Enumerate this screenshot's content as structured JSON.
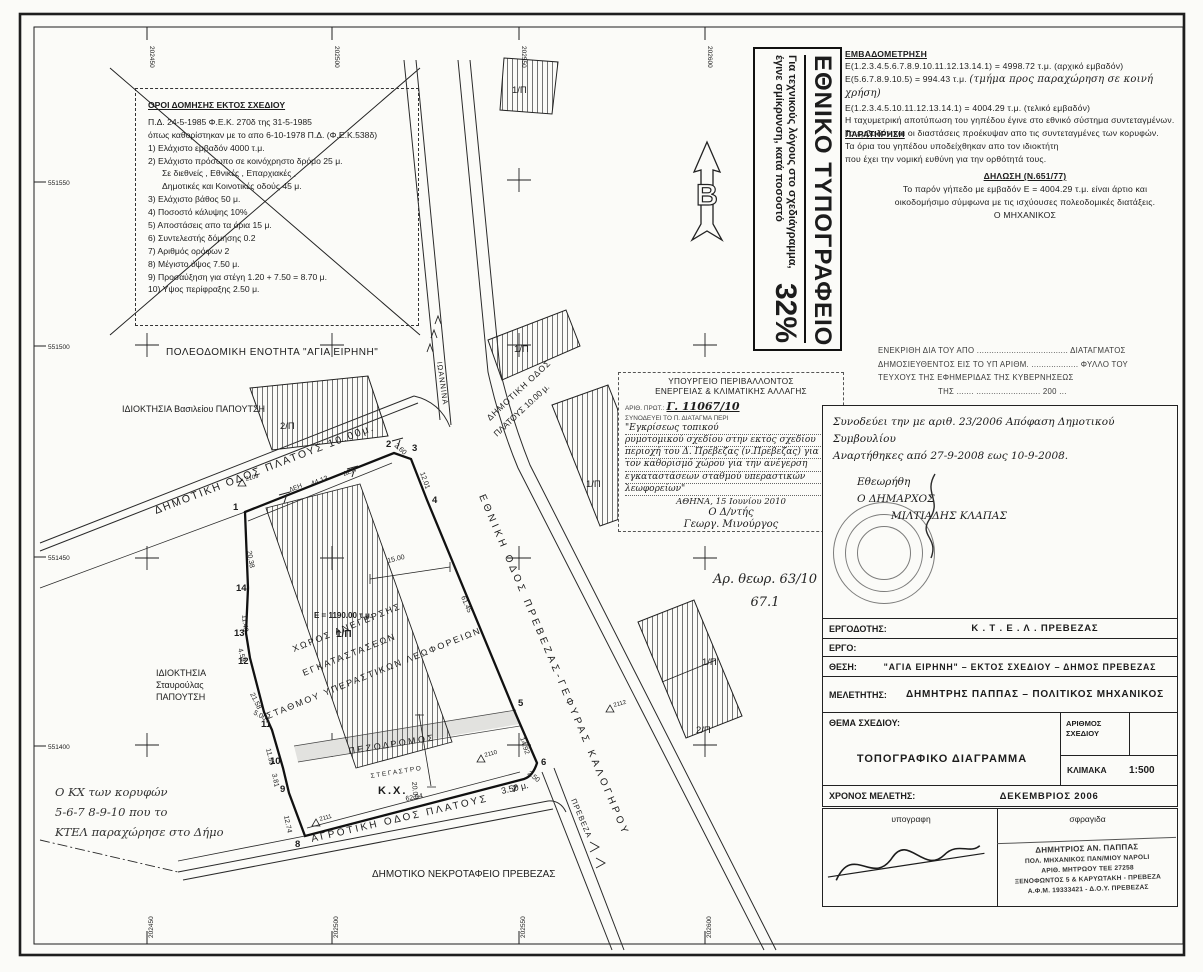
{
  "printing_office": {
    "title": "ΕΘΝΙΚΟ ΤΥΠΟΓΡΑΦΕΙΟ",
    "note": "Για τεχνικούς λόγους στο σχεδιάγραμμα, έγινε σμίκρυνση, κατά ποσοστό",
    "percent": "32%"
  },
  "regulations": {
    "title": "ΟΡΟΙ ΔΟΜΗΣΗΣ ΕΚΤΟΣ ΣΧΕΔΙΟΥ",
    "decree_line1": "Π.Δ. 24-5-1985 Φ.Ε.Κ. 270δ της 31-5-1985",
    "decree_line2": "όπως καθορίστηκαν με το απο 6-10-1978 Π.Δ. (Φ.Ε.Κ.538δ)",
    "items": [
      "1) Ελάχιστο εμβαδόν 4000 τ.μ.",
      "2) Ελάχιστο πρόσωπο σε κοινόχρηστο δρόμο 25 μ.",
      "Σε διεθνείς , Εθνικές , Επαρχιακές ,",
      "Δημοτικές και Κοινοτικές οδούς 45 μ.",
      "3) Ελάχιστο βάθος 50 μ.",
      "4) Ποσοστό κάλυψης 10%",
      "5) Αποστάσεις απο τα όρια 15 μ.",
      "6) Συντελεστής δόμησης 0.2",
      "7) Αριθμός ορόφων 2",
      "8) Μέγιστο ύψος 7.50 μ.",
      "9) Προσαύξηση για στέγη 1.20 + 7.50 = 8.70 μ.",
      "10) Υψος περίφραξης 2.50 μ."
    ]
  },
  "area_measurement": {
    "title": "ΕΜΒΑΔΟΜΕΤΡΗΣΗ",
    "line1": "Ε(1.2.3.4.5.6.7.8.9.10.11.12.13.14.1) = 4998.72 τ.μ. (αρχικό εμβαδόν)",
    "line2_start": "Ε(5.6.7.8.9.10.5) = 994.43 τ.μ.",
    "line2_hand": "(τμήμα προς παραχώρηση σε κοινή χρήση)",
    "line3": "Ε(1.2.3.4.5.10.11.12.13.14.1) = 4004.29 τ.μ. (τελικό εμβαδόν)",
    "line4": "Η ταχυμετρική αποτύπωση του γηπέδου έγινε στο εθνικό σύστημα συντεταγμένων.",
    "line5": "Το εμβαδόν και οι διαστάσεις προέκυψαν απο τις συντεταγμένες των κορυφών."
  },
  "observation": {
    "title": "ΠΑΡΑΤΗΡΗΣΗ",
    "line1": "Τα όρια του γηπέδου υποδείχθηκαν απο τον ιδιοκτήτη",
    "line2": "που έχει την νομική ευθύνη για την ορθότητά τους."
  },
  "declaration": {
    "title": "ΔΗΛΩΣΗ (Ν.651/77)",
    "line1": "Το παρόν γήπεδο με εμβαδόν Ε = 4004.29 τ.μ. είναι άρτιο και",
    "line2": "οικοδομήσιμο σύμφωνα με τις ισχύουσες πολεοδομικές διατάξεις.",
    "signer": "Ο ΜΗΧΑΝΙΚΟΣ"
  },
  "gazette_approval": {
    "line1": "ΕΝΕΚΡΙΘΗ ΔΙΑ ΤΟΥ ΑΠΟ ..................................... ΔΙΑΤΑΓΜΑΤΟΣ",
    "line2": "ΔΗΜΟΣΙΕΥΘΕΝΤΟΣ ΕΙΣ ΤΟ ΥΠ ΑΡΙΘΜ. ................... ΦΥΛΛΟ ΤΟΥ",
    "line3": "ΤΕΥΧΟΥΣ ΤΗΣ ΕΦΗΜΕΡΙΔΑΣ ΤΗΣ ΚΥΒΕΡΝΗΣΕΩΣ",
    "line4": "ΤΗΣ ....... .......................... 200 ..."
  },
  "ministry_stamp": {
    "line1": "ΥΠΟΥΡΓΕΙΟ ΠΕΡΙΒΑΛΛΟΝΤΟΣ",
    "line2": "ΕΝΕΡΓΕΙΑΣ & ΚΛΙΜΑΤΙΚΗΣ ΑΛΛΑΓΗΣ",
    "protocol_label": "ΑΡΙΘ. ΠΡΩΤ.:",
    "protocol_value": "Γ. 11067/10",
    "accompanies_label": "ΣΥΝΟΔΕΥΕΙ ΤΟ Π. ΔΙΑΤΑΓΜΑ ΠΕΡΙ",
    "subject_lines": [
      "\"Εγκρίσεως τοπικού",
      "ρυμοτομικού σχεδίου στην εκτός σχεδίου",
      "περιοχή του Δ. Πρέβεζας (ν.Πρέβεζας) για",
      "τον καθορισμό χώρου για την ανέγερση",
      "εγκαταστάσεων σταθμού υπεραστικών",
      "λεωφορείων\""
    ],
    "date_line": "ΑΘΗΝΑ, 15 Ιουνίου 2010",
    "signer_title": "Ο Δ/ντής",
    "signature": "Γεωργ. Μινούργος"
  },
  "council_note": {
    "line1": "Συνοδεύει την με αριθ. 23/2006 Απόφαση Δημοτικού Συμβουλίου",
    "line2": "Αναρτήθηκες από 27-9-2008 εως 10-9-2008.",
    "approved": "Εθεωρήθη",
    "mayor_title": "Ο ΔΗΜΑΡΧΟΣ",
    "mayor_name": "ΜΙΛΤΙΑΔΗΣ ΚΛΑΠΑΣ"
  },
  "file_note": {
    "line1": "Αρ. θεωρ. 63/10",
    "line2": "67.1"
  },
  "kx_note": {
    "line1": "Ο ΚΧ των κορυφών",
    "line2": "5-6-7 8-9-10 που το",
    "line3": "ΚΤΕΛ παραχώρησε στο Δήμο"
  },
  "title_block": {
    "client_label": "ΕΡΓΟΔΟΤΗΣ:",
    "client": "Κ . Τ . Ε . Λ .   ΠΡΕΒΕΖΑΣ",
    "project_label": "ΕΡΓΟ:",
    "project": "",
    "location_label": "ΘΕΣΗ:",
    "location": "\"ΑΓΙΑ ΕΙΡΗΝΗ\" – ΕΚΤΟΣ ΣΧΕΔΙΟΥ – ΔΗΜΟΣ ΠΡΕΒΕΖΑΣ",
    "designer_label": "ΜΕΛΕΤΗΤΗΣ:",
    "designer": "ΔΗΜΗΤΡΗΣ ΠΑΠΠΑΣ – ΠΟΛΙΤΙΚΟΣ ΜΗΧΑΝΙΚΟΣ",
    "subject_label": "ΘΕΜΑ ΣΧΕΔΙΟΥ:",
    "subject": "ΤΟΠΟΓΡΑΦΙΚΟ ΔΙΑΓΡΑΜΜΑ",
    "number_label": "ΑΡΙΘΜΟΣ ΣΧΕΔΙΟΥ",
    "number": "",
    "scale_label": "ΚΛΙΜΑΚΑ",
    "scale": "1:500",
    "date_label": "ΧΡΟΝΟΣ ΜΕΛΕΤΗΣ:",
    "date": "ΔΕΚΕΜΒΡΙΟΣ 2006",
    "signature_label": "υπογραφη",
    "stamp_label": "σφραγιδα",
    "stamp_lines": [
      "ΔΗΜΗΤΡΙΟΣ ΑΝ. ΠΑΠΠΑΣ",
      "ΠΟΛ. ΜΗΧΑΝΙΚΟΣ ΠΑΝ/ΜΙΟΥ NAPOLI",
      "ΑΡΙΘ. ΜΗΤΡΩΟΥ ΤΕΕ 27258",
      "ΞΕΝΟΦΩΝΤΟΣ 5 & ΚΑΡΥΩΤΑΚΗ - ΠΡΕΒΕΖΑ",
      "Α.Φ.Μ. 19333421 - Δ.Ο.Υ. ΠΡΕΒΕΖΑΣ"
    ]
  },
  "drawing": {
    "texts": [
      {
        "t": "202450",
        "x": 150,
        "y": 46,
        "r": 90,
        "s": 6.5,
        "n": "grid-coordinate"
      },
      {
        "t": "202500",
        "x": 335,
        "y": 46,
        "r": 90,
        "s": 6.5,
        "n": "grid-coordinate"
      },
      {
        "t": "202550",
        "x": 522,
        "y": 46,
        "r": 90,
        "s": 6.5,
        "n": "grid-coordinate"
      },
      {
        "t": "202600",
        "x": 708,
        "y": 46,
        "r": 90,
        "s": 6.5,
        "n": "grid-coordinate"
      },
      {
        "t": "551550",
        "x": 48,
        "y": 185,
        "s": 6.5,
        "n": "grid-coordinate"
      },
      {
        "t": "551500",
        "x": 48,
        "y": 349,
        "s": 6.5,
        "n": "grid-coordinate"
      },
      {
        "t": "551450",
        "x": 48,
        "y": 560,
        "s": 6.5,
        "n": "grid-coordinate"
      },
      {
        "t": "551400",
        "x": 48,
        "y": 749,
        "s": 6.5,
        "n": "grid-coordinate"
      },
      {
        "t": "202450",
        "x": 153,
        "y": 938,
        "r": -90,
        "s": 6.5,
        "n": "grid-coordinate"
      },
      {
        "t": "202500",
        "x": 338,
        "y": 938,
        "r": -90,
        "s": 6.5,
        "n": "grid-coordinate"
      },
      {
        "t": "202550",
        "x": 525,
        "y": 938,
        "r": -90,
        "s": 6.5,
        "n": "grid-coordinate"
      },
      {
        "t": "202600",
        "x": 711,
        "y": 938,
        "r": -90,
        "s": 6.5,
        "n": "grid-coordinate"
      },
      {
        "t": "ΠΟΛΕΟΔΟΜΙΚΗ ΕΝΟΤΗΤΑ \"ΑΓΙΑ ΕΙΡΗΝΗ\"",
        "x": 166,
        "y": 355,
        "s": 10,
        "ls": 0.5,
        "n": "planning-unit-label"
      },
      {
        "t": "ΙΔΙΟΚΤΗΣΙΑ Βασιλείου ΠΑΠΟΥΤΣΗ",
        "x": 122,
        "y": 412,
        "s": 9,
        "n": "ownership-label"
      },
      {
        "t": "ΙΔΙΟΚΤΗΣΙΑ",
        "x": 156,
        "y": 676,
        "s": 9,
        "n": "ownership-label"
      },
      {
        "t": "Σταυρούλας",
        "x": 156,
        "y": 688,
        "s": 9,
        "n": "ownership-label"
      },
      {
        "t": "ΠΑΠΟΥΤΣΗ",
        "x": 156,
        "y": 700,
        "s": 9,
        "n": "ownership-label"
      },
      {
        "t": "ΔΗΜΟΤΙΚΟ ΝΕΚΡΟΤΑΦΕΙΟ ΠΡΕΒΕΖΑΣ",
        "x": 372,
        "y": 877,
        "s": 10,
        "n": "cemetery-label"
      },
      {
        "t": "ΔΗΜΟΤΙΚΗ ΟΔΟΣ ΠΛΑΤΟΥΣ 10.00μ.",
        "x": 156,
        "y": 514,
        "r": -21,
        "s": 10.5,
        "ls": 2,
        "n": "road-label"
      },
      {
        "t": "ΔΗΜΟΤΙΚΗ ΟΔΟΣ",
        "x": 490,
        "y": 421,
        "r": -43,
        "s": 8.5,
        "ls": 1,
        "n": "road-label"
      },
      {
        "t": "ΠΛΑΤΟΥΣ 10.00 μ.",
        "x": 497,
        "y": 437,
        "r": -43,
        "s": 8.5,
        "n": "road-label"
      },
      {
        "t": "ΕΘΝΙΚΗ ΟΔΟΣ ΠΡΕΒΕΖΑΣ-ΓΕΦΥΡΑΣ ΚΑΛΟΓΗΡΟΥ",
        "x": 479,
        "y": 496,
        "r": 67,
        "s": 10,
        "ls": 3.5,
        "n": "road-label"
      },
      {
        "t": "ΙΩΑΝΝΙΝΑ",
        "x": 437,
        "y": 362,
        "r": 82,
        "s": 7.5,
        "ls": 1,
        "n": "direction-label"
      },
      {
        "t": "ΠΡΕΒΕΖΑ",
        "x": 571,
        "y": 800,
        "r": 67,
        "s": 7.5,
        "ls": 1,
        "n": "direction-label"
      },
      {
        "t": "Π Ε Ζ Ο Δ Ρ Ο Μ Ο Σ",
        "x": 349,
        "y": 754,
        "r": -9,
        "s": 9,
        "n": "pedestrian-way-label"
      },
      {
        "t": "Σ Τ Ε Γ Α Σ Τ Ρ Ο",
        "x": 371,
        "y": 778,
        "r": -9,
        "s": 6.5,
        "n": "shelter-label"
      },
      {
        "t": "Κ.Χ.",
        "x": 378,
        "y": 794,
        "s": 11,
        "ls": 2,
        "b": 1,
        "n": "common-space-label"
      },
      {
        "t": "ΑΓΡΟΤΙΚΗ ΟΔΟΣ ΠΛΑΤΟΥΣ",
        "x": 312,
        "y": 842,
        "r": -13,
        "s": 10,
        "ls": 2.5,
        "n": "road-label"
      },
      {
        "t": "3.50 μ.",
        "x": 502,
        "y": 794,
        "r": -13,
        "s": 9,
        "n": "road-label"
      },
      {
        "t": "ΧΩΡΟΣ ΑΝΕΓΕΡΣΗΣ",
        "x": 294,
        "y": 652,
        "r": -22,
        "s": 9,
        "ls": 2,
        "n": "building-area-label"
      },
      {
        "t": "ΕΓΚΑΤΑΣΤΑΣΕΩΝ",
        "x": 304,
        "y": 676,
        "r": -22,
        "s": 9,
        "ls": 2,
        "n": "building-area-label"
      },
      {
        "t": "ΣΤΑΘΜΟΥ ΥΠΕΡΑΣΤΙΚΩΝ ΛΕΩΦΟΡΕΙΩΝ",
        "x": 268,
        "y": 719,
        "r": -22,
        "s": 9,
        "ls": 2,
        "n": "building-area-label"
      },
      {
        "t": "Ε = 1190.00 τ.μ.",
        "x": 314,
        "y": 618,
        "s": 8,
        "b": 1,
        "n": "area-value"
      },
      {
        "t": "1/Π",
        "x": 336,
        "y": 637,
        "s": 10,
        "b": 1,
        "n": "block-label"
      },
      {
        "t": "1/Π",
        "x": 514,
        "y": 352,
        "s": 9.5,
        "n": "block-label"
      },
      {
        "t": "1/Π",
        "x": 586,
        "y": 487,
        "s": 9.5,
        "n": "block-label"
      },
      {
        "t": "1/Π",
        "x": 702,
        "y": 665,
        "s": 9.5,
        "n": "block-label"
      },
      {
        "t": "2/Π",
        "x": 696,
        "y": 733,
        "s": 9.5,
        "n": "block-label"
      },
      {
        "t": "2/Π",
        "x": 280,
        "y": 429,
        "s": 9.5,
        "n": "block-label"
      },
      {
        "t": "1/Π",
        "x": 512,
        "y": 93,
        "s": 9.5,
        "n": "block-label"
      },
      {
        "t": "1",
        "x": 233,
        "y": 510,
        "s": 9.5,
        "b": 1,
        "n": "vertex-number"
      },
      {
        "t": "2",
        "x": 386,
        "y": 447,
        "s": 9.5,
        "b": 1,
        "n": "vertex-number"
      },
      {
        "t": "3",
        "x": 412,
        "y": 451,
        "s": 9.5,
        "b": 1,
        "n": "vertex-number"
      },
      {
        "t": "4",
        "x": 432,
        "y": 503,
        "s": 9.5,
        "b": 1,
        "n": "vertex-number"
      },
      {
        "t": "5",
        "x": 518,
        "y": 706,
        "s": 9.5,
        "b": 1,
        "n": "vertex-number"
      },
      {
        "t": "6",
        "x": 541,
        "y": 765,
        "s": 9.5,
        "b": 1,
        "n": "vertex-number"
      },
      {
        "t": "7",
        "x": 512,
        "y": 792,
        "s": 9.5,
        "b": 1,
        "n": "vertex-number"
      },
      {
        "t": "8",
        "x": 295,
        "y": 847,
        "s": 9.5,
        "b": 1,
        "n": "vertex-number"
      },
      {
        "t": "9",
        "x": 280,
        "y": 792,
        "s": 9.5,
        "b": 1,
        "n": "vertex-number"
      },
      {
        "t": "10",
        "x": 270,
        "y": 764,
        "s": 9.5,
        "b": 1,
        "n": "vertex-number"
      },
      {
        "t": "11",
        "x": 261,
        "y": 727,
        "s": 9.5,
        "b": 1,
        "n": "vertex-number"
      },
      {
        "t": "12",
        "x": 238,
        "y": 664,
        "s": 9.5,
        "b": 1,
        "n": "vertex-number"
      },
      {
        "t": "13",
        "x": 234,
        "y": 636,
        "s": 9.5,
        "b": 1,
        "n": "vertex-number"
      },
      {
        "t": "14",
        "x": 236,
        "y": 591,
        "s": 9.5,
        "b": 1,
        "n": "vertex-number"
      },
      {
        "t": "ΔΕΗ",
        "x": 290,
        "y": 492,
        "r": -21,
        "s": 6.5,
        "n": "utility-pole-label"
      },
      {
        "t": "44.13",
        "x": 312,
        "y": 486,
        "r": -21,
        "s": 7,
        "n": "dimension"
      },
      {
        "t": "ΔΕΗ",
        "x": 344,
        "y": 476,
        "r": -21,
        "s": 6.5,
        "n": "utility-pole-label"
      },
      {
        "t": "2.60",
        "x": 394,
        "y": 446,
        "r": 42,
        "s": 7,
        "n": "dimension"
      },
      {
        "t": "12.01",
        "x": 420,
        "y": 473,
        "r": 70,
        "s": 7,
        "n": "dimension"
      },
      {
        "t": "61.45",
        "x": 461,
        "y": 597,
        "r": 67,
        "s": 7,
        "n": "dimension"
      },
      {
        "t": "15.00",
        "x": 388,
        "y": 563,
        "r": -14,
        "s": 7,
        "n": "dimension"
      },
      {
        "t": "14.92",
        "x": 520,
        "y": 738,
        "r": 72,
        "s": 7,
        "n": "dimension"
      },
      {
        "t": "2.50",
        "x": 527,
        "y": 774,
        "r": 38,
        "s": 7,
        "n": "dimension"
      },
      {
        "t": "62.04",
        "x": 406,
        "y": 801,
        "r": -11,
        "s": 7,
        "n": "dimension"
      },
      {
        "t": "20.38",
        "x": 247,
        "y": 551,
        "r": 80,
        "s": 7,
        "n": "dimension"
      },
      {
        "t": "11.43",
        "x": 242,
        "y": 615,
        "r": 84,
        "s": 7,
        "n": "dimension"
      },
      {
        "t": "4.59",
        "x": 238,
        "y": 649,
        "r": 74,
        "s": 7,
        "n": "dimension"
      },
      {
        "t": "21.58",
        "x": 250,
        "y": 694,
        "r": 64,
        "s": 7,
        "n": "dimension"
      },
      {
        "t": "5.00",
        "x": 253,
        "y": 714,
        "r": 28,
        "s": 7,
        "n": "dimension"
      },
      {
        "t": "11.55",
        "x": 266,
        "y": 749,
        "r": 76,
        "s": 7,
        "n": "dimension"
      },
      {
        "t": "3.81",
        "x": 272,
        "y": 774,
        "r": 78,
        "s": 7,
        "n": "dimension"
      },
      {
        "t": "12.74",
        "x": 284,
        "y": 816,
        "r": 78,
        "s": 7,
        "n": "dimension"
      },
      {
        "t": "20.00",
        "x": 412,
        "y": 782,
        "r": 85,
        "s": 7,
        "n": "dimension"
      },
      {
        "t": "2109",
        "x": 246,
        "y": 481,
        "r": -15,
        "s": 6,
        "n": "survey-point"
      },
      {
        "t": "2111",
        "x": 320,
        "y": 821,
        "r": -15,
        "s": 6,
        "n": "survey-point"
      },
      {
        "t": "2110",
        "x": 485,
        "y": 757,
        "r": -15,
        "s": 6,
        "n": "survey-point"
      },
      {
        "t": "2112",
        "x": 614,
        "y": 707,
        "r": -15,
        "s": 6,
        "n": "survey-point"
      },
      {
        "t": "Β",
        "x": 707,
        "y": 205,
        "s": 30,
        "b": 1,
        "a": "middle",
        "o": 1,
        "n": "north-arrow-letter"
      }
    ]
  }
}
